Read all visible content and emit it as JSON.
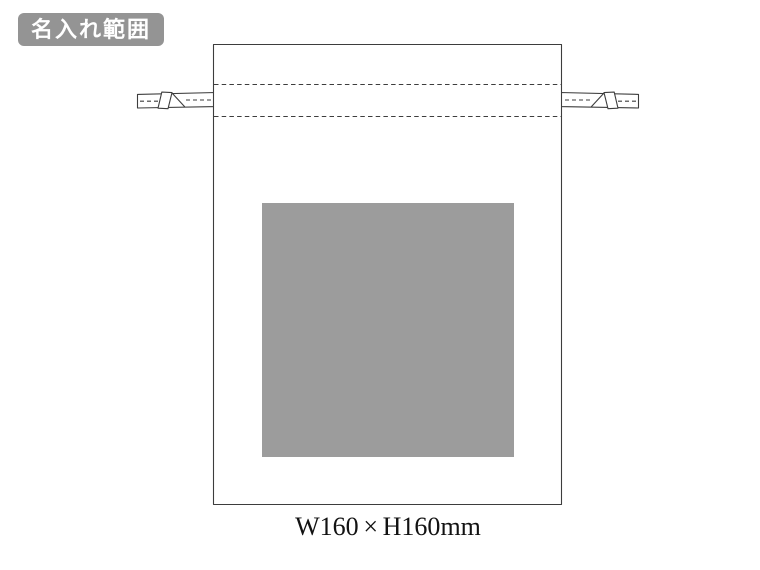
{
  "badge": {
    "label": "名入れ範囲",
    "bg": "#949494",
    "fg": "#ffffff"
  },
  "diagram": {
    "kind": "drawstring-bag-print-area",
    "line_color": "#3d3d3d",
    "bag_fill": "#ffffff",
    "print_area_fill": "#9c9c9c"
  },
  "caption": {
    "width": "W160",
    "times": "×",
    "height": "H160",
    "unit": "mm"
  }
}
